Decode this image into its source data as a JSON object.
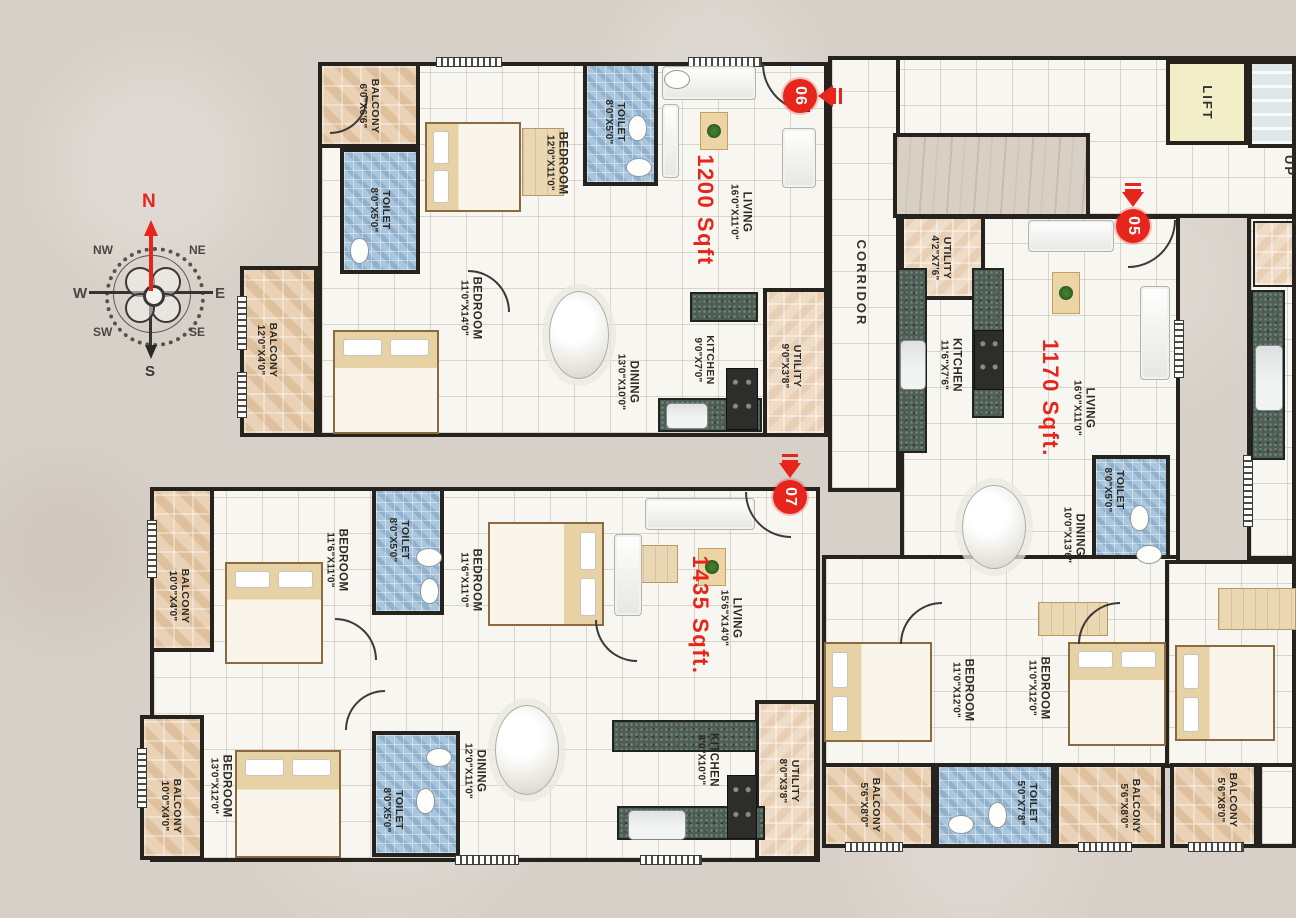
{
  "palette": {
    "wall": "#26231f",
    "accent_red": "#e8251c",
    "background": "#d7d0c8",
    "toilet_blue": "#a9c6dd",
    "balcony_tan": "#e9d2b5",
    "counter_green": "#4d5f55",
    "lift_yellow": "#f1eec8"
  },
  "compass": {
    "n": "N",
    "ne": "NE",
    "e": "E",
    "se": "SE",
    "s": "S",
    "sw": "SW",
    "w": "W",
    "nw": "NW"
  },
  "common": {
    "corridor": "CORRIDOR",
    "lift": "LIFT",
    "up": "UP"
  },
  "units": [
    {
      "number": "06",
      "area": "1200 Sqft"
    },
    {
      "number": "05",
      "area": "1170 Sqft."
    },
    {
      "number": "07",
      "area": "1435 Sqft."
    }
  ],
  "rooms": [
    {
      "name": "BALCONY",
      "dims": "6'0\"X6'6\""
    },
    {
      "name": "BEDROOM",
      "dims": "12'0\"X11'0\""
    },
    {
      "name": "TOILET",
      "dims": "8'0\"X5'0\""
    },
    {
      "name": "TOILET",
      "dims": "8'0\"X5'0\""
    },
    {
      "name": "BEDROOM",
      "dims": "11'0\"X14'0\""
    },
    {
      "name": "BALCONY",
      "dims": "12'0\"X4'0\""
    },
    {
      "name": "LIVING",
      "dims": "16'0\"X11'0\""
    },
    {
      "name": "DINING",
      "dims": "13'0\"X10'0\""
    },
    {
      "name": "KITCHEN",
      "dims": "9'0\"X7'0\""
    },
    {
      "name": "UTILITY",
      "dims": "9'0\"X3'8\""
    },
    {
      "name": "UTILITY",
      "dims": "4'2\"X7'6\""
    },
    {
      "name": "KITCHEN",
      "dims": "11'6\"X7'6\""
    },
    {
      "name": "LIVING",
      "dims": "16'0\"X11'0\""
    },
    {
      "name": "DINING",
      "dims": "10'0\"X13'6\""
    },
    {
      "name": "TOILET",
      "dims": "8'0\"X5'0\""
    },
    {
      "name": "BEDROOM",
      "dims": "11'0\"X12'0\""
    },
    {
      "name": "BEDROOM",
      "dims": "11'0\"X12'0\""
    },
    {
      "name": "BALCONY",
      "dims": "5'6\"X8'0\""
    },
    {
      "name": "TOILET",
      "dims": "5'0\"X7'8\""
    },
    {
      "name": "BALCONY",
      "dims": "5'6\"X8'0\""
    },
    {
      "name": "BALCONY",
      "dims": "5'6\"X8'0\""
    },
    {
      "name": "BALCONY",
      "dims": "10'0\"X4'0\""
    },
    {
      "name": "BEDROOM",
      "dims": "11'6\"X11'0\""
    },
    {
      "name": "TOILET",
      "dims": "8'0\"X5'0\""
    },
    {
      "name": "BEDROOM",
      "dims": "11'6\"X11'0\""
    },
    {
      "name": "LIVING",
      "dims": "15'6\"X14'0\""
    },
    {
      "name": "BEDROOM",
      "dims": "13'0\"X12'0\""
    },
    {
      "name": "BALCONY",
      "dims": "10'0\"X4'0\""
    },
    {
      "name": "TOILET",
      "dims": "8'0\"X5'0\""
    },
    {
      "name": "DINING",
      "dims": "12'0\"X11'0\""
    },
    {
      "name": "KITCHEN",
      "dims": "8'0\"X10'0\""
    },
    {
      "name": "UTILITY",
      "dims": "8'0\"X3'8\""
    }
  ]
}
